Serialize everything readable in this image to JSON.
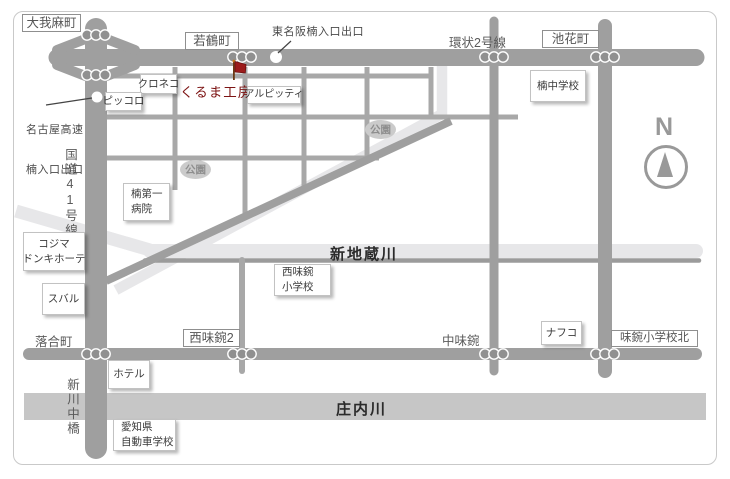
{
  "map": {
    "poi": {
      "name": "くるま工房",
      "marker": "red-flag-icon"
    },
    "icons": {
      "traffic_signal": "three-dot-signal",
      "ramp_marker": "white-circle",
      "poi_marker": "red-flag",
      "compass": "north-arrow"
    },
    "road_boxes": [
      {
        "label": "大我麻町"
      },
      {
        "label": "若鶴町"
      },
      {
        "label": "池花町"
      },
      {
        "label": "西味鋺2"
      },
      {
        "label": "味鋺小学校北"
      }
    ],
    "road_texts": [
      {
        "label": "環状2号線"
      },
      {
        "label": "落合町"
      },
      {
        "label": "中味鋺"
      }
    ],
    "vertical_texts": [
      {
        "label": "国道41号線"
      },
      {
        "label": "新川中橋"
      }
    ],
    "callouts": [
      {
        "line1": "名古屋高速",
        "line2": "楠入口出口"
      },
      {
        "line1": "東名阪楠入口出口",
        "line2": ""
      }
    ],
    "rivers": [
      {
        "name": "新地蔵川"
      },
      {
        "name": "庄内川"
      }
    ],
    "parks": [
      {
        "label": "公園"
      },
      {
        "label": "公園"
      }
    ],
    "landmarks": [
      {
        "line1": "クロネコ",
        "line2": ""
      },
      {
        "line1": "ピッコロ",
        "line2": ""
      },
      {
        "line1": "アルピッティ",
        "line2": ""
      },
      {
        "line1": "楠中学校",
        "line2": ""
      },
      {
        "line1": "楠第一",
        "line2": "病院"
      },
      {
        "line1": "コジマ",
        "line2": "ドンキホーテ"
      },
      {
        "line1": "スバル",
        "line2": ""
      },
      {
        "line1": "西味鋺",
        "line2": "小学校"
      },
      {
        "line1": "ホテル",
        "line2": ""
      },
      {
        "line1": "愛知県",
        "line2": "自動車学校"
      },
      {
        "line1": "ナフコ",
        "line2": ""
      }
    ],
    "compass": {
      "label": "N"
    }
  }
}
